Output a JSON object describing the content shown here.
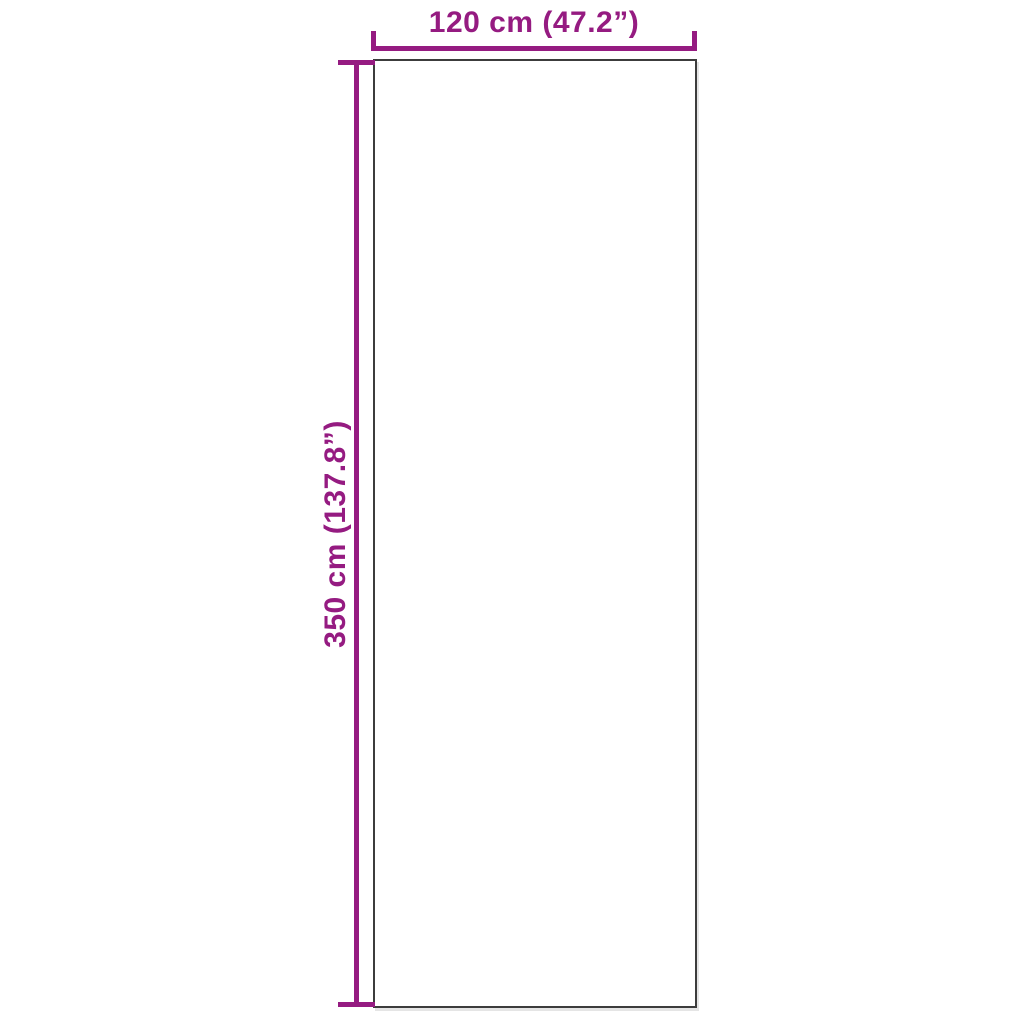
{
  "diagram": {
    "type": "product-dimension-diagram",
    "width_label": "120 cm (47.2”)",
    "height_label": "350 cm (137.8”)"
  },
  "colors": {
    "accent": "#951b81",
    "outline": "#3c3c3c",
    "background": "#ffffff"
  }
}
